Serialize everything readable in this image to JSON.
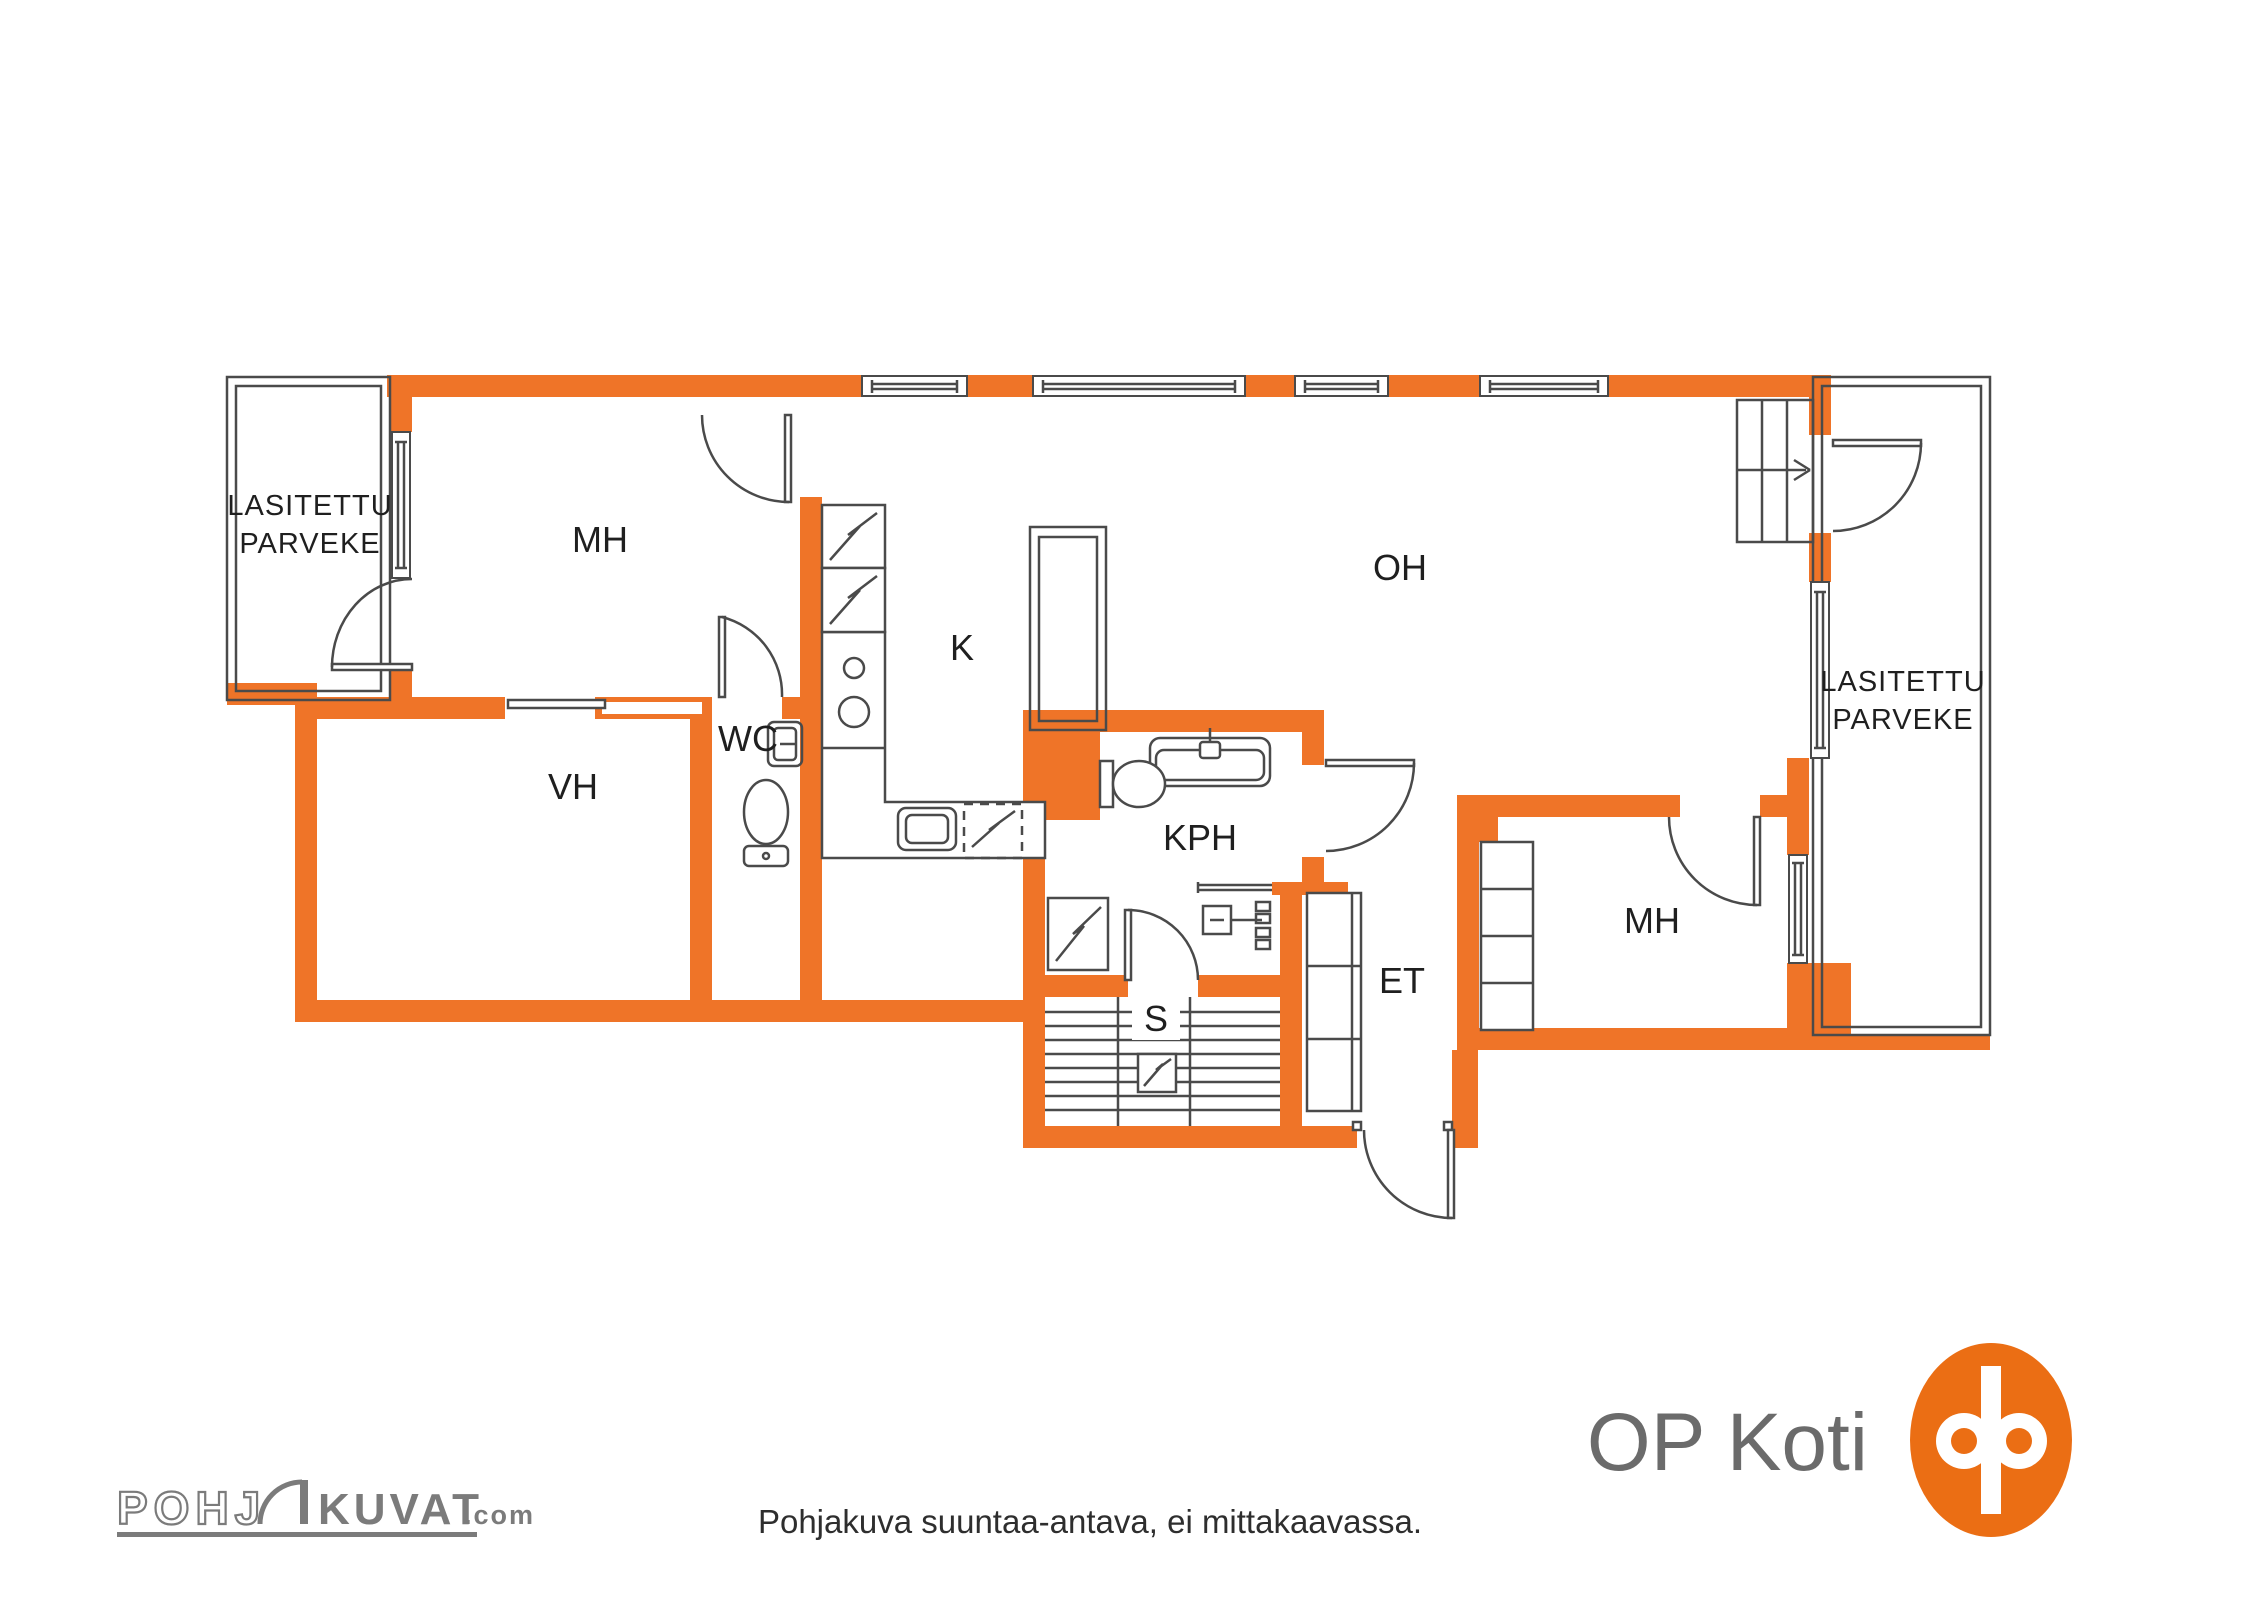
{
  "colors": {
    "wall": "#EF7428",
    "line": "#4a4a4a",
    "label": "#1f1f1f",
    "caption": "#2e2e2e",
    "brand_gray": "#6b6b6b",
    "watermark_gray": "#7b7b7b",
    "op_logo_orange": "#EB6E14"
  },
  "rooms": {
    "balcony_left": {
      "line1": "LASITETTU",
      "line2": "PARVEKE"
    },
    "bedroom_top": "MH",
    "closet": "VH",
    "toilet_room": "WC",
    "kitchen": "K",
    "living_room": "OH",
    "bathroom": "KPH",
    "sauna": "S",
    "entry": "ET",
    "bedroom_right": "MH",
    "balcony_right": {
      "line1": "LASITETTU",
      "line2": "PARVEKE"
    }
  },
  "footer": {
    "disclaimer": "Pohjakuva suuntaa-antava, ei mittakaavassa."
  },
  "branding": {
    "op_koti": "OP Koti",
    "watermark": {
      "prefix": "POHJ",
      "suffix": "KUVAT",
      "domain": ".com"
    }
  }
}
